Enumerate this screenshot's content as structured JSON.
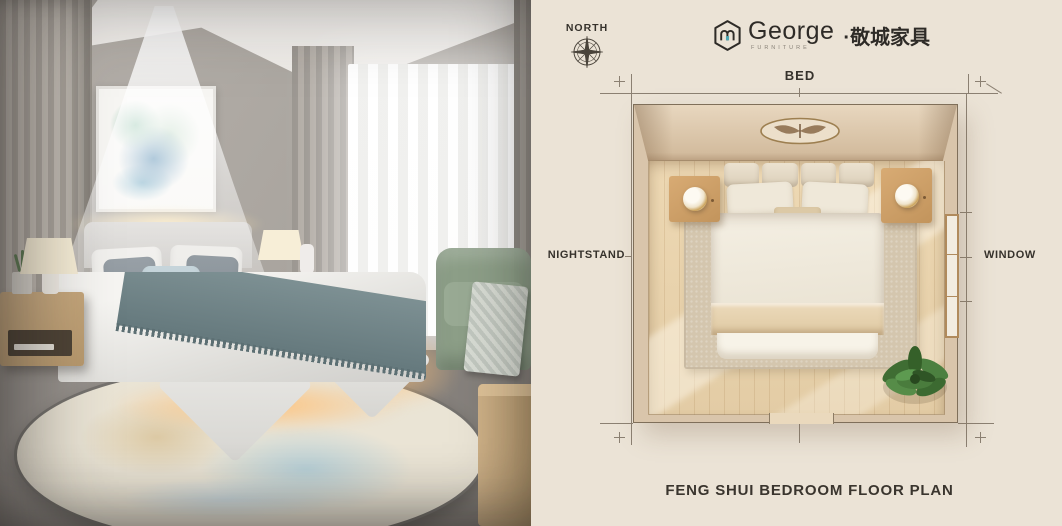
{
  "photo": {
    "description": "Bedroom photo: floating bed with sheer canopy, LED underglow, round rug, abstract wall art, green armchair"
  },
  "plan": {
    "north_label": "NORTH",
    "logo": {
      "brand": "George",
      "division": "FURNITURE",
      "separator": "·",
      "cjk_name": "敬城家具"
    },
    "labels": {
      "bed": "BED",
      "nightstand": "NIGHTSTAND",
      "window": "WINDOW"
    },
    "caption": "FENG SHUI BEDROOM FLOOR PLAN",
    "icons": {
      "compass": "compass-rose-icon",
      "logo_mark": "hexagon-monogram-icon"
    },
    "colors": {
      "panel_background": "#ebe3d6",
      "dimension_line": "#8b8072",
      "label_text": "#36322c",
      "wall": "#d9c5ab",
      "wood_floor": "#e9d4ae",
      "rug": "#d4c6ae",
      "logo_accent_teal": "#4da7b4",
      "plant_green": "#4a7c3d"
    }
  }
}
